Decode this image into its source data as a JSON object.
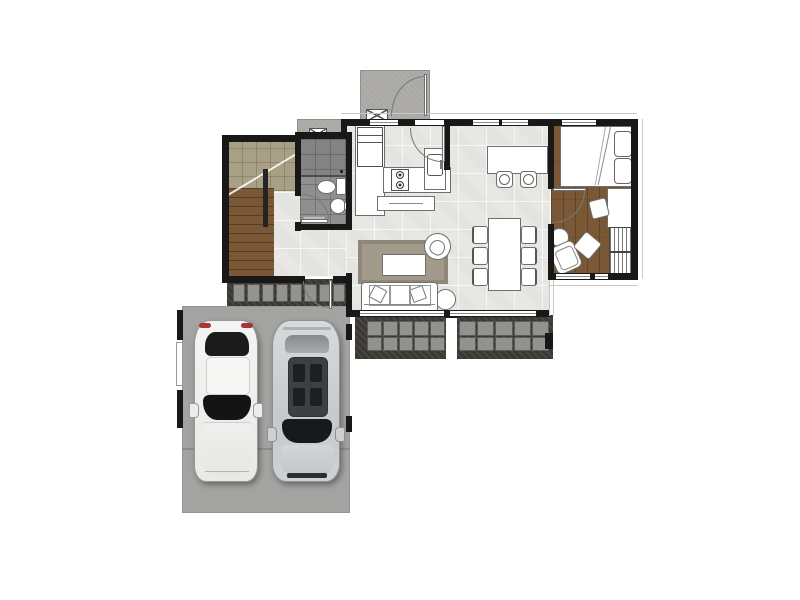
{
  "document": {
    "type": "architectural-floor-plan",
    "view": "top-down",
    "background": "#ffffff"
  },
  "palette": {
    "wall": "#181818",
    "tile_floor": "#e8e7e3",
    "bathroom_tile": "#8f8f8f",
    "under_stair_tile": "#a89f85",
    "wood_floor": "#7a5836",
    "porch_concrete": "#a9a8a4",
    "garage_concrete": "#a3a3a1",
    "gravel": "#3b3733",
    "paver": "#929290",
    "rug": "#a29b8c",
    "furniture_fill": "#ffffff",
    "furniture_line": "#6e6e6e",
    "car_white": "#f2f2f0",
    "car_silver": "#c9cdd0",
    "taillight_red": "#a83434",
    "glass_dark": "#17191b"
  },
  "rooms": {
    "kitchen": {
      "name": "Kitchen"
    },
    "bathroom": {
      "name": "Bathroom"
    },
    "staircase": {
      "name": "Staircase"
    },
    "living_dining": {
      "name": "Living / Dining room"
    },
    "bedroom": {
      "name": "Bedroom"
    },
    "garage": {
      "name": "Garage (2 cars)"
    },
    "rear_porch": {
      "name": "Rear porch"
    },
    "front_porch": {
      "name": "Entry porch"
    },
    "side_walkway": {
      "name": "Side walkway"
    },
    "terrace": {
      "name": "Terrace"
    }
  },
  "furniture": {
    "kitchen": [
      "fridge",
      "counter",
      "stove-2-burner",
      "sink",
      "island"
    ],
    "bathroom": [
      "shower",
      "toilet",
      "pedestal-sink",
      "bath-mat"
    ],
    "dining": [
      "bar-counter",
      "bar-stool x2",
      "dining-table",
      "dining-chair x6"
    ],
    "living": [
      "rug",
      "coffee-table",
      "sofa-3-seat",
      "armchair",
      "round-side-table"
    ],
    "bedroom": [
      "double-bed",
      "pillow x2",
      "desk",
      "desk-chair",
      "wardrobe",
      "armchair",
      "ottoman",
      "round-side-table"
    ]
  },
  "vehicles": {
    "count": 2,
    "items": [
      {
        "name": "white-car"
      },
      {
        "name": "silver-car"
      }
    ]
  },
  "doors": [
    "rear-porch-door",
    "kitchen-back-door",
    "bathroom-door",
    "bedroom-door",
    "side-walkway-door"
  ],
  "windows": {
    "top_wall": 4,
    "bedroom_bottom": 2,
    "living_bottom": 2,
    "garage_left": 1
  }
}
